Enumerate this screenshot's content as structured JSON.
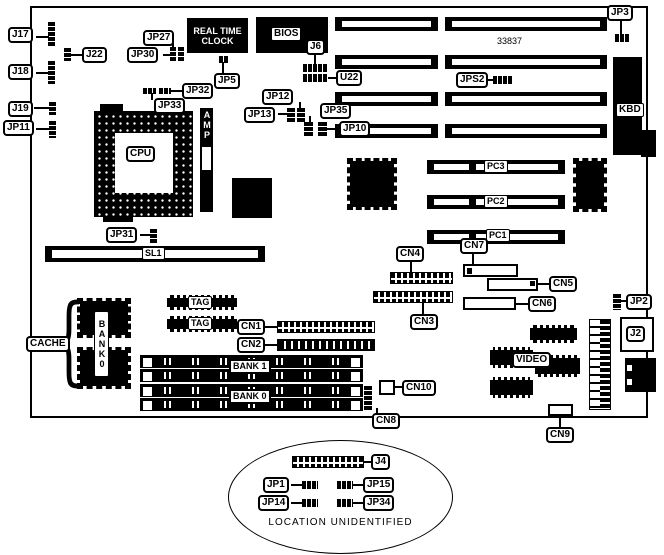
{
  "diagram": {
    "part_number": "33837",
    "note": "LOCATION UNIDENTIFIED"
  },
  "components": {
    "rtc": "REAL TIME CLOCK",
    "bios": "BIOS",
    "cpu": "CPU",
    "amp": "AMP",
    "kbd": "KBD",
    "video": "VIDEO",
    "cache": "CACHE",
    "cache_bank": "BANK0",
    "tag_a": "TAG",
    "tag_b": "TAG",
    "simm_bank1": "BANK 1",
    "simm_bank0": "BANK 0"
  },
  "labels": {
    "j17": "J17",
    "j18": "J18",
    "j19": "J19",
    "jp11": "JP11",
    "j22": "J22",
    "jp27": "JP27",
    "jp30": "JP30",
    "jp32": "JP32",
    "jp33": "JP33",
    "jp5": "JP5",
    "j6": "J6",
    "u22": "U22",
    "jp12": "JP12",
    "jp13": "JP13",
    "jp35": "JP35",
    "jp10": "JP10",
    "jp3": "JP3",
    "jps2": "JPS2",
    "jp31": "JP31",
    "sl1": "SL1",
    "pc1": "PC1",
    "pc2": "PC2",
    "pc3": "PC3",
    "cn1": "CN1",
    "cn2": "CN2",
    "cn3": "CN3",
    "cn4": "CN4",
    "cn5": "CN5",
    "cn6": "CN6",
    "cn7": "CN7",
    "cn8": "CN8",
    "cn9": "CN9",
    "cn10": "CN10",
    "jp2": "JP2",
    "j2": "J2",
    "j4": "J4",
    "jp1": "JP1",
    "jp15": "JP15",
    "jp14": "JP14",
    "jp34": "JP34"
  },
  "icons": {
    "brace": "{"
  }
}
